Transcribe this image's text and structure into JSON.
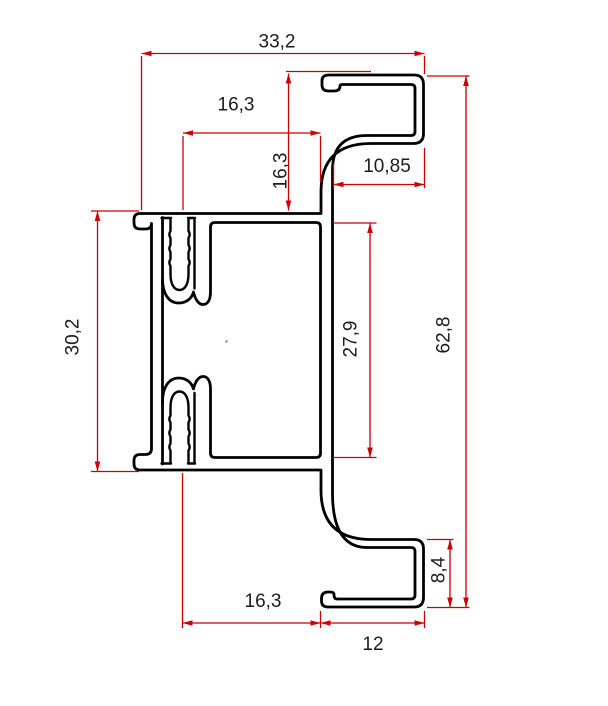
{
  "drawing": {
    "type": "technical-cross-section-aluminium-profile",
    "background": "#ffffff",
    "outline_color": "#000000",
    "dimension_color": "#cc0000",
    "label_color": "#1c1c1c",
    "labels": {
      "overall_width_top": "33,2",
      "rebate_width_top": "16,3",
      "rebate_height": "16,3",
      "hook_depth_top": "10,85",
      "body_height_left": "30,2",
      "inner_height": "27,9",
      "overall_height": "62,8",
      "hook_height_bottom": "8,4",
      "web_width_bottom": "16,3",
      "hook_width_bottom": "12"
    }
  }
}
